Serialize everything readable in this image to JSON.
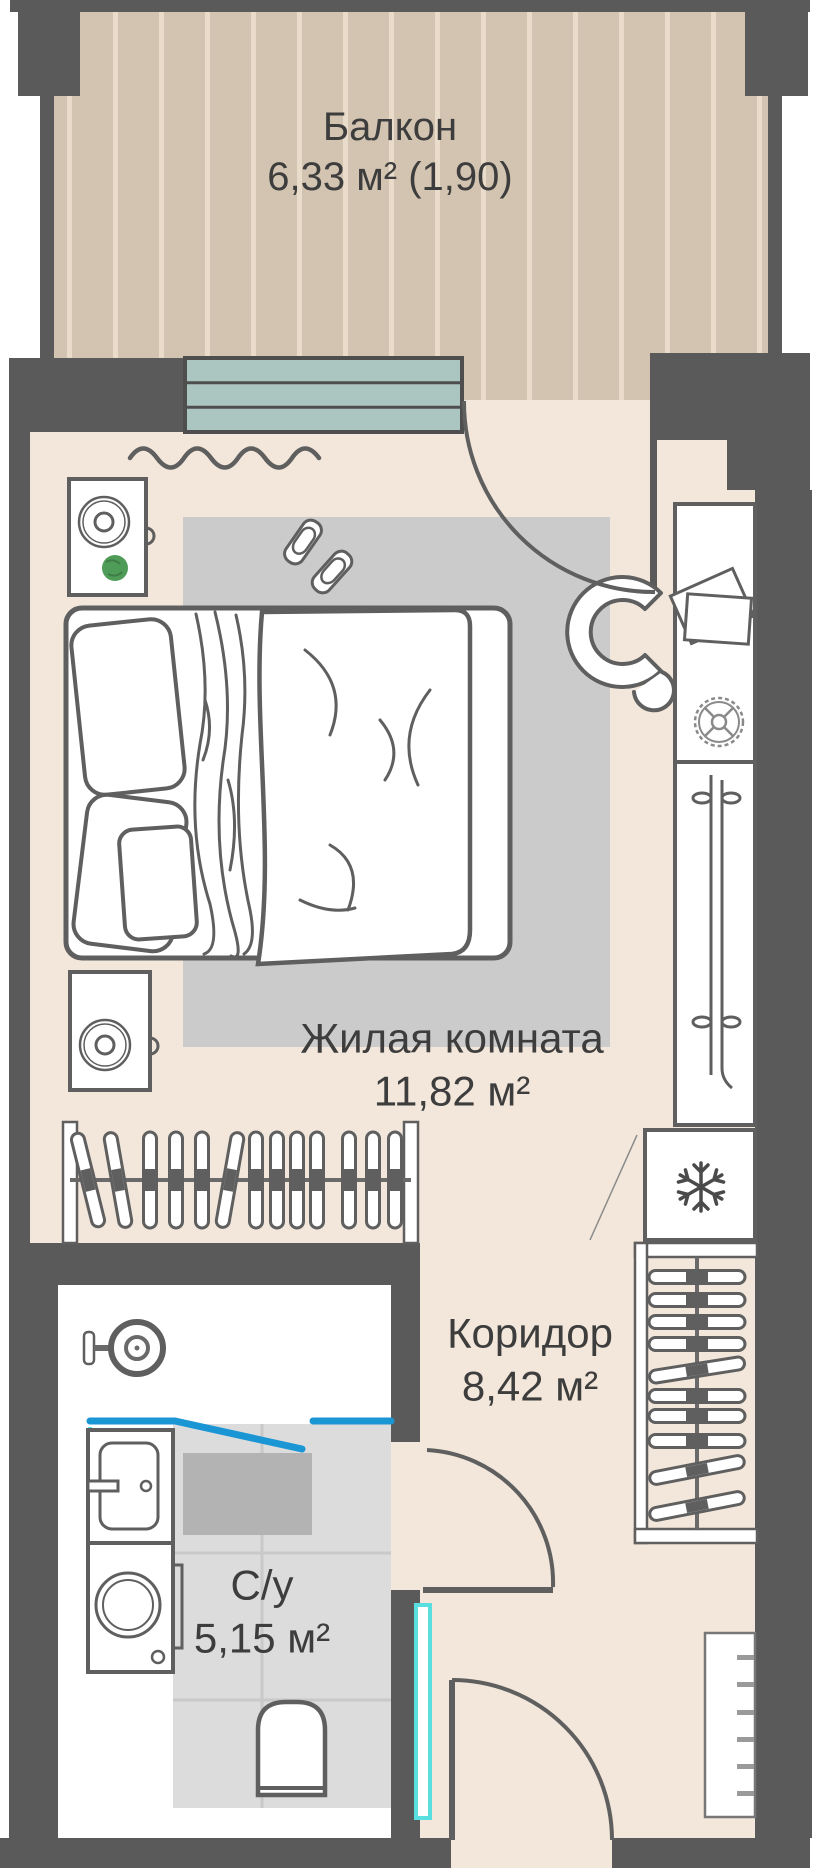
{
  "rooms": {
    "balcony": {
      "name": "Балкон",
      "area": "6,33 м² (1,90)"
    },
    "living_room": {
      "name": "Жилая комната",
      "area": "11,82 м²"
    },
    "corridor": {
      "name": "Коридор",
      "area": "8,42 м²"
    },
    "bathroom": {
      "name": "С/у",
      "area": "5,15 м²"
    }
  },
  "colors": {
    "wall": "#5a5a5a",
    "room_floor": "#f2e7da",
    "balcony_floor": "#d3c4b1",
    "plank_line": "#e9dccb",
    "rug": "#cbcbcb",
    "tile": "#dcdcdc",
    "tile_grid": "#c9c9c9",
    "shower_mat": "#b3b3b3",
    "window_glass": "#abc5c1",
    "glass_blue": "#1b96d4",
    "glass_cyan": "#59dfdf",
    "plant_green": "#4f9c59",
    "outline": "#5f5f5f",
    "text": "#3d3d3d"
  }
}
